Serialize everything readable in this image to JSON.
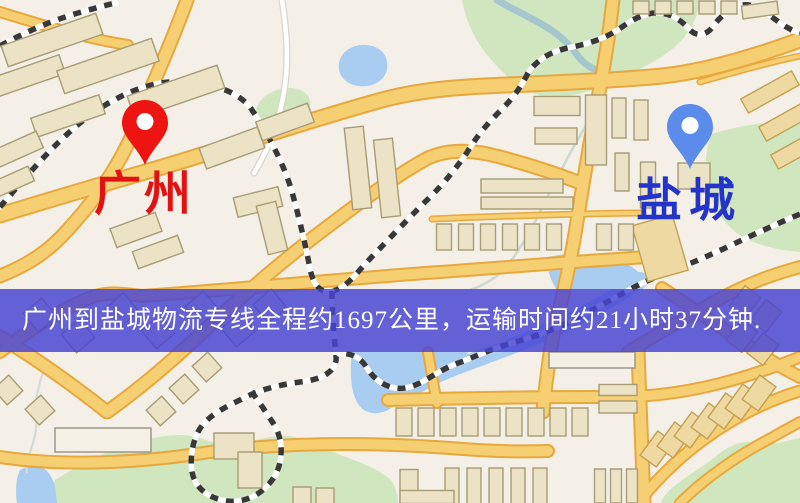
{
  "banner": {
    "text": "广州到盐城物流专线全程约1697公里，运输时间约21小时37分钟.",
    "background": "#4643d4",
    "opacity": 0.83,
    "text_color": "#ffffff"
  },
  "markers": [
    {
      "id": "origin",
      "city": "广州",
      "pin_color": "#ee1411",
      "label_color": "#e31111"
    },
    {
      "id": "destination",
      "city": "盐城",
      "pin_color": "#5c8ceb",
      "label_color": "#2433c8"
    }
  ],
  "route": {
    "origin": "广州",
    "destination": "盐城",
    "distance_km": 1697,
    "duration_text": "21小时37分钟"
  },
  "map": {
    "colors": {
      "background": "#f4efe7",
      "road_fill": "#f6cf72",
      "road_casing": "#e7a83e",
      "building": "#ece2c6",
      "building_honey": "#eed9a2",
      "park": "#cfe6bf",
      "water": "#a8cdf0",
      "railway": "#383838"
    }
  }
}
